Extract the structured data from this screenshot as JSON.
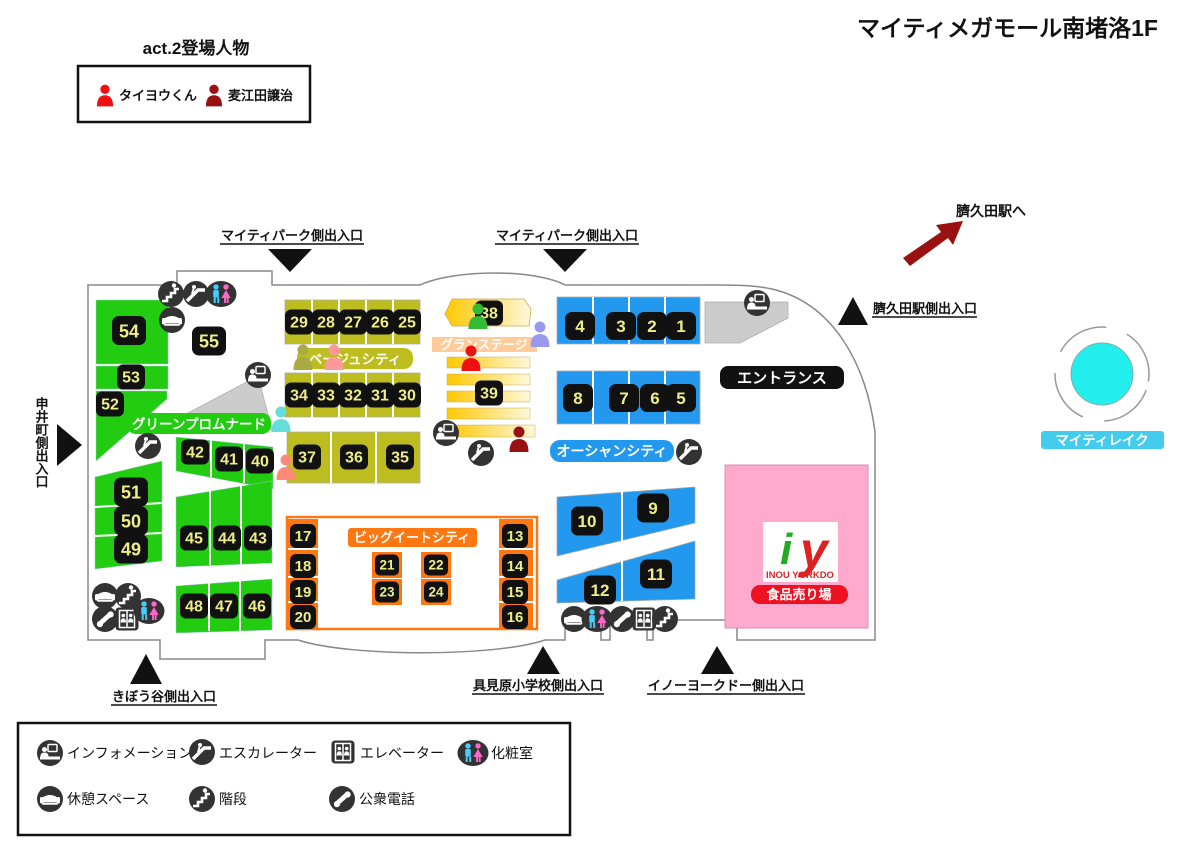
{
  "title": "マイティメガモール南堵洛1F",
  "cast": {
    "heading": "act.2登場人物",
    "member1": "タイヨウくん",
    "member2": "麦江田譲治"
  },
  "station": {
    "to_label": "臍久田駅へ"
  },
  "exits": {
    "mighty_park": "マイティパーク側出入口",
    "hesokuda_station": "臍久田駅側出入口",
    "saruicho": "申井町側出入口",
    "kibodani": "きぼう谷側出入口",
    "gumihara": "具見原小学校側出入口",
    "inou_yorkdo": "イノーヨークドー側出入口"
  },
  "zones": {
    "green_promenade": "グリーンプロムナード",
    "beige_city": "ベージュシティ",
    "grand_stage": "グランステージ",
    "ocean_city": "オーシャンシティ",
    "big_eat_city": "ビッグイートシティ",
    "entrance": "エントランス",
    "mighty_lake": "マイティレイク"
  },
  "store": {
    "logo_i": "i",
    "logo_y": "y",
    "name": "INOU YORKDO",
    "dept": "食品売り場"
  },
  "shops": {
    "n1": "1",
    "n2": "2",
    "n3": "3",
    "n4": "4",
    "n5": "5",
    "n6": "6",
    "n7": "7",
    "n8": "8",
    "n9": "9",
    "n10": "10",
    "n11": "11",
    "n12": "12",
    "n13": "13",
    "n14": "14",
    "n15": "15",
    "n16": "16",
    "n17": "17",
    "n18": "18",
    "n19": "19",
    "n20": "20",
    "n21": "21",
    "n22": "22",
    "n23": "23",
    "n24": "24",
    "n25": "25",
    "n26": "26",
    "n27": "27",
    "n28": "28",
    "n29": "29",
    "n30": "30",
    "n31": "31",
    "n32": "32",
    "n33": "33",
    "n34": "34",
    "n35": "35",
    "n36": "36",
    "n37": "37",
    "n38": "38",
    "n39": "39",
    "n40": "40",
    "n41": "41",
    "n42": "42",
    "n43": "43",
    "n44": "44",
    "n45": "45",
    "n46": "46",
    "n47": "47",
    "n48": "48",
    "n49": "49",
    "n50": "50",
    "n51": "51",
    "n52": "52",
    "n53": "53",
    "n54": "54",
    "n55": "55"
  },
  "legend": {
    "information": "インフォメーション",
    "escalator": "エスカレーター",
    "elevator": "エレベーター",
    "restroom": "化粧室",
    "rest_space": "休憩スペース",
    "stairs": "階段",
    "phone": "公衆電話"
  },
  "colors": {
    "green": "#22CC11",
    "olive": "#BDBD1F",
    "blue": "#2299EE",
    "orange": "#FF7711",
    "pink": "#FFAACC",
    "gray": "#CCCCCC",
    "gold_a": "#FFC800",
    "gold_b": "#FFF8DC",
    "peach": "#FFCC99",
    "lake": "#22EEEE",
    "lake_label": "#44CCEE",
    "badge_red": "#EE1122",
    "label_bg": "#111111",
    "num": "#EEEE88",
    "cast_red": "#EE1111",
    "cast_darkred": "#991111",
    "p_cyan": "#66DDDD",
    "p_green": "#33BB33",
    "p_olive": "#AAAA44",
    "p_pink": "#FF9999",
    "p_salmon": "#FF8877",
    "p_lavender": "#9999EE",
    "logo_green": "#22AA22",
    "logo_red": "#DD2222"
  }
}
